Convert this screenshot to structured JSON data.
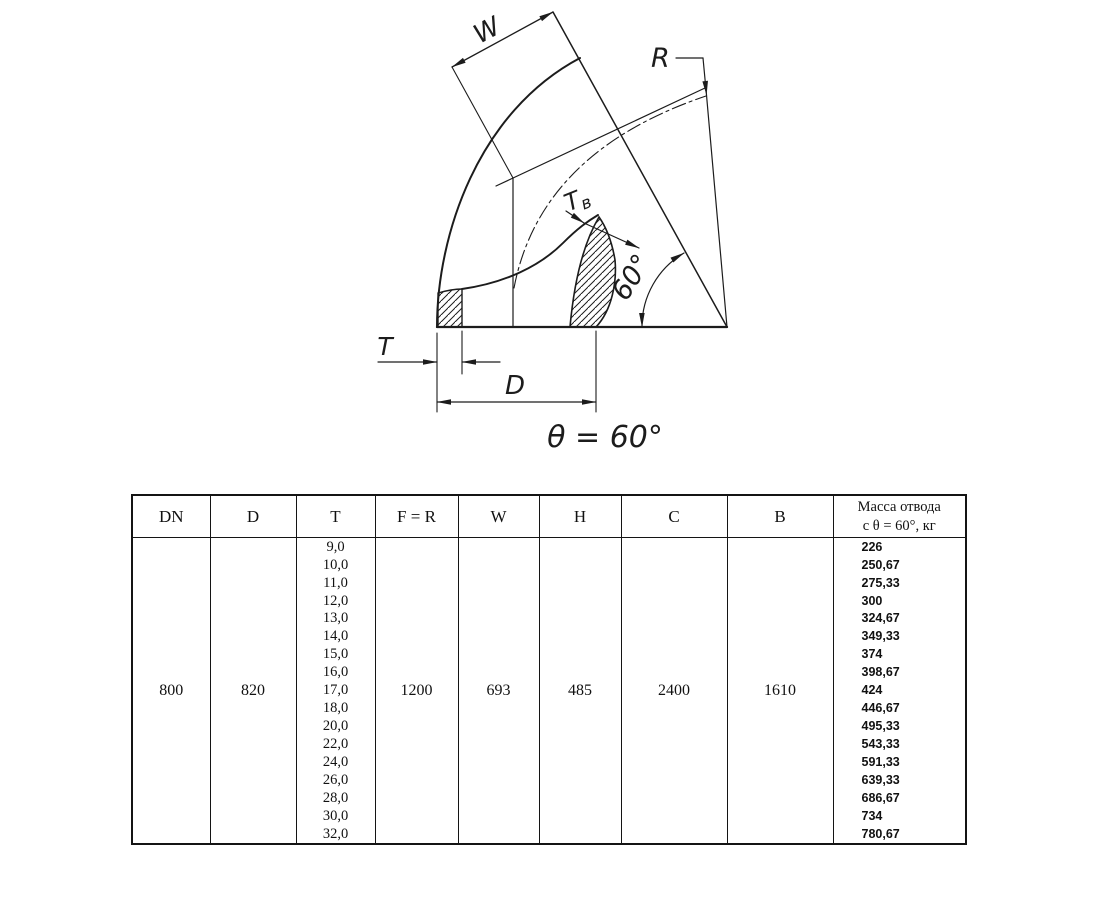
{
  "drawing": {
    "labels": {
      "w": "W",
      "r": "R",
      "tv": "T",
      "tv_sub": "в",
      "angle_arc": "60°",
      "t": "T",
      "d": "D",
      "theta": "θ = 60°"
    }
  },
  "table": {
    "headers": [
      "DN",
      "D",
      "T",
      "F = R",
      "W",
      "H",
      "C",
      "B"
    ],
    "mass_header": {
      "line1": "Масса отвода",
      "line2": "с θ = 60°, кг"
    },
    "row": {
      "dn": "800",
      "d": "820",
      "t_values": [
        "9,0",
        "10,0",
        "11,0",
        "12,0",
        "13,0",
        "14,0",
        "15,0",
        "16,0",
        "17,0",
        "18,0",
        "20,0",
        "22,0",
        "24,0",
        "26,0",
        "28,0",
        "30,0",
        "32,0"
      ],
      "f_r": "1200",
      "w": "693",
      "h": "485",
      "c": "2400",
      "b": "1610",
      "mass_values": [
        "226",
        "250,67",
        "275,33",
        "300",
        "324,67",
        "349,33",
        "374",
        "398,67",
        "424",
        "446,67",
        "495,33",
        "543,33",
        "591,33",
        "639,33",
        "686,67",
        "734",
        "780,67"
      ]
    }
  }
}
